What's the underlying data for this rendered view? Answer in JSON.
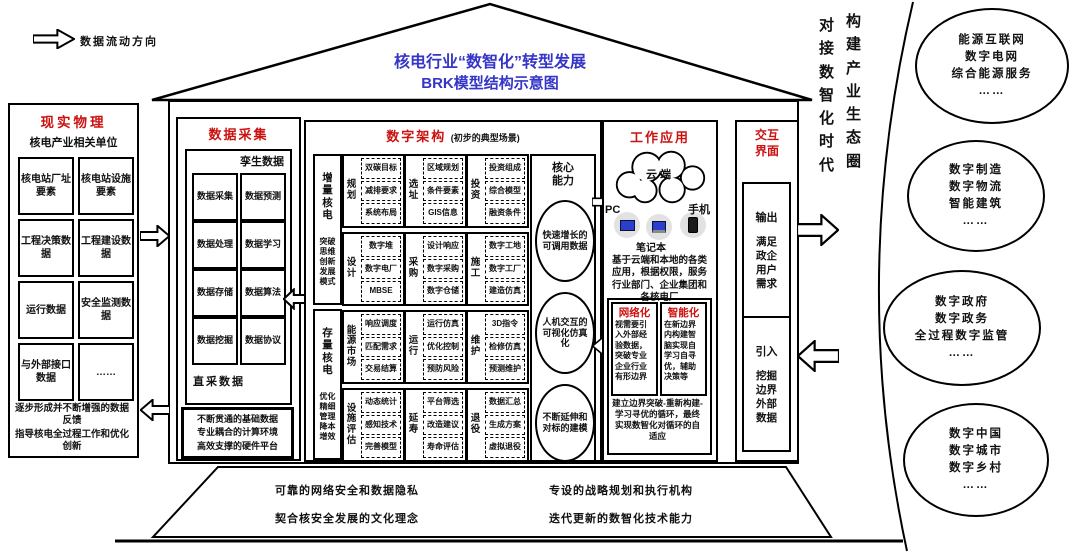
{
  "legend": {
    "label": "数据流动方向"
  },
  "roof": {
    "title_line1": "核电行业“数智化”转型发展",
    "title_line2": "BRK模型结构示意图"
  },
  "physical": {
    "title": "现实物理",
    "subtitle": "核电产业相关单位",
    "cells": [
      "核电站厂址要素",
      "核电站设施要素",
      "工程决策数据",
      "工程建设数据",
      "运行数据",
      "安全监测数据",
      "与外部接口数据",
      "……"
    ],
    "note1": "逐步形成并不断增强的数据反馈",
    "note2": "指导核电全过程工作和优化创新"
  },
  "collection": {
    "title": "数据采集",
    "twin_label": "孪生数据",
    "cells": [
      "数据采集",
      "数据预测",
      "数据处理",
      "数据学习",
      "数据存储",
      "数据算法",
      "数据挖掘",
      "数据协议"
    ],
    "direct_label": "直采数据",
    "foundation1": "不断贯通的基础数据",
    "foundation2": "专业耦合的计算环境",
    "foundation3": "高效支撑的硬件平台"
  },
  "architecture": {
    "title": "数字架构",
    "subtitle": "(初步的典型场景)",
    "strips": [
      {
        "head": "增量核电",
        "body": "突破思维创新发展模式"
      },
      {
        "head": "存量核电",
        "body": "优化精细管理降本增效"
      }
    ],
    "rows": [
      [
        {
          "label": "规划",
          "items": [
            "双碳目标",
            "减排要求",
            "系统布局"
          ]
        },
        {
          "label": "选址",
          "items": [
            "区域规划",
            "条件要素",
            "GIS信息"
          ]
        },
        {
          "label": "投资",
          "items": [
            "投资组成",
            "综合模型",
            "融资条件"
          ]
        }
      ],
      [
        {
          "label": "设计",
          "items": [
            "数字堆",
            "数字电厂",
            "MBSE"
          ]
        },
        {
          "label": "采购",
          "items": [
            "设计响应",
            "数字采购",
            "数字仓储"
          ]
        },
        {
          "label": "施工",
          "items": [
            "数字工地",
            "数字工厂",
            "建造仿真"
          ]
        }
      ],
      [
        {
          "label": "能源市场",
          "items": [
            "响应调度",
            "匹配需求",
            "交易结算"
          ]
        },
        {
          "label": "运行",
          "items": [
            "运行仿真",
            "优化控制",
            "预防风险"
          ]
        },
        {
          "label": "维护",
          "items": [
            "3D指令",
            "检修仿真",
            "预测维护"
          ]
        }
      ],
      [
        {
          "label": "设施评估",
          "items": [
            "动态统计",
            "感知技术",
            "完善模型"
          ]
        },
        {
          "label": "延寿",
          "items": [
            "平台筛选",
            "改造建议",
            "寿命评估"
          ]
        },
        {
          "label": "退役",
          "items": [
            "数据汇总",
            "生成方案",
            "虚拟退役"
          ]
        }
      ]
    ],
    "core": {
      "title": "核心能力",
      "bubbles": [
        "快速增长的可调用数据",
        "人机交互的可视化仿真化",
        "不断延伸和对标的建模"
      ]
    }
  },
  "application": {
    "title": "工作应用",
    "cloud_label": "云端",
    "device_pc": "PC",
    "device_laptop": "笔记本",
    "device_phone": "手机",
    "desc": "基于云端和本地的各类应用，根据权限，服务行业部门、企业集团和各核电厂",
    "network": {
      "title": "网络化",
      "text": "视需要引入外部经验数据，突破专业企业行业有形边界"
    },
    "intelligent": {
      "title": "智能化",
      "text": "在新边界内构建智脑实现自学习自寻优，辅助决策等"
    },
    "loop_text": "建立边界突破-重新构建-学习寻优的循环，最终实现数智化对循环的自适应"
  },
  "interface": {
    "title": "交互界面",
    "output_head": "输出",
    "output_text": "满足政企用户需求",
    "input_head": "引入",
    "input_text": "挖掘边界外部数据"
  },
  "right": {
    "vertical1": "对接数智化时代",
    "vertical2": "构建产业生态圈",
    "bubbles": [
      [
        "能源互联网",
        "数字电网",
        "综合能源服务",
        "……"
      ],
      [
        "数字制造",
        "数字物流",
        "智能建筑",
        "……"
      ],
      [
        "数字政府",
        "数字政务",
        "全过程数字监管",
        "……"
      ],
      [
        "数字中国",
        "数字城市",
        "数字乡村",
        "……"
      ]
    ]
  },
  "foundation": {
    "left1": "可靠的网络安全和数据隐私",
    "left2": "契合核安全发展的文化理念",
    "right1": "专设的战略规划和执行机构",
    "right2": "迭代更新的数智化技术能力"
  },
  "colors": {
    "accent_red": "#cc1111",
    "accent_blue": "#3535c8"
  }
}
